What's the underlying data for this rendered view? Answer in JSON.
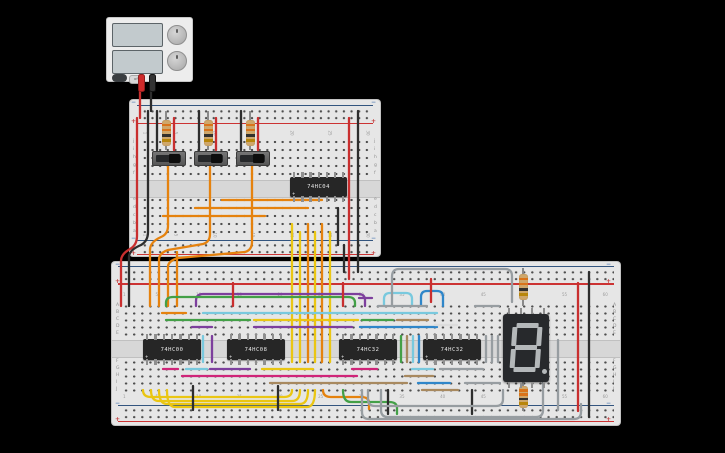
{
  "app": {
    "background": "#000000"
  },
  "power_supply": {
    "toggle_label": "off",
    "screens": 2,
    "knobs": 2,
    "probe_colors": [
      "#cf2b2b",
      "#333333"
    ]
  },
  "boards": {
    "upper": {
      "rows_top": [
        "j",
        "i",
        "h",
        "g",
        "f"
      ],
      "rows_bottom": [
        "e",
        "d",
        "c",
        "b",
        "a"
      ],
      "cols": [
        1,
        5,
        10,
        15,
        20,
        25,
        30
      ],
      "minus": "−",
      "plus": "+"
    },
    "lower": {
      "rows_top": [
        "A",
        "B",
        "C",
        "D",
        "E"
      ],
      "rows_bottom": [
        "F",
        "G",
        "H",
        "I",
        "J"
      ],
      "cols": [
        1,
        5,
        10,
        15,
        20,
        25,
        30,
        35,
        40,
        45,
        50,
        55,
        60
      ],
      "minus": "−",
      "plus": "+"
    }
  },
  "components": {
    "ic_mark": "+",
    "ics": [
      {
        "label": "74HC04",
        "x": 290,
        "y": 177,
        "w": 57,
        "h": 20,
        "pins": 7
      },
      {
        "label": "74HC00",
        "x": 143,
        "y": 339,
        "w": 58,
        "h": 21,
        "pins": 7
      },
      {
        "label": "74HC08",
        "x": 227,
        "y": 339,
        "w": 58,
        "h": 21,
        "pins": 7
      },
      {
        "label": "74HC32",
        "x": 339,
        "y": 339,
        "w": 58,
        "h": 21,
        "pins": 7
      },
      {
        "label": "74HC32",
        "x": 423,
        "y": 339,
        "w": 58,
        "h": 21,
        "pins": 7
      }
    ],
    "switches": [
      {
        "x": 152,
        "y": 151
      },
      {
        "x": 194,
        "y": 151
      },
      {
        "x": 236,
        "y": 151
      }
    ],
    "resistors": [
      {
        "x": 166,
        "lead": [
          111,
          150
        ],
        "body": [
          120,
          146
        ]
      },
      {
        "x": 208,
        "lead": [
          111,
          150
        ],
        "body": [
          120,
          146
        ]
      },
      {
        "x": 250,
        "lead": [
          111,
          150
        ],
        "body": [
          120,
          146
        ]
      },
      {
        "x": 523,
        "lead": [
          268,
          306
        ],
        "body": [
          274,
          300
        ]
      },
      {
        "x": 523,
        "lead": [
          382,
          411
        ],
        "body": [
          386,
          408
        ]
      }
    ],
    "resistor_bands": [
      "#d9731a",
      "#d9731a",
      "#33302c",
      "#b8860b"
    ],
    "display": {
      "x": 503,
      "y": 314,
      "w": 46,
      "h": 68,
      "value": "8."
    }
  },
  "colors": {
    "red": "#c92f2f",
    "black": "#2d2d2d",
    "orange": "#e5820e",
    "yellow": "#eac613",
    "green": "#43a047",
    "cyan": "#79c9de",
    "blue": "#2f86c9",
    "purple": "#7d3f9d",
    "pink": "#cf2579",
    "brown": "#a8895f",
    "dgray": "#979da1",
    "lightgray": "#dcdcdc"
  },
  "wires": [
    {
      "c": "red",
      "d": "M140,88 V118"
    },
    {
      "c": "black",
      "d": "M151,88 V111"
    },
    {
      "c": "red",
      "d": "M137,118 V236 Q137,245 130,249 Q121,254 121,261 V306"
    },
    {
      "c": "black",
      "d": "M148,111 V232 Q148,241 141,245 Q129,250 129,257 V306"
    },
    {
      "c": "red",
      "d": "M349,118 V279"
    },
    {
      "c": "black",
      "d": "M358,111 V272"
    },
    {
      "c": "black",
      "d": "M338,208 V245"
    },
    {
      "c": "black",
      "d": "M344,245 V272"
    },
    {
      "c": "black",
      "d": "M157,111 V150"
    },
    {
      "c": "black",
      "d": "M199,111 V150"
    },
    {
      "c": "black",
      "d": "M241,111 V150"
    },
    {
      "c": "red",
      "d": "M174,118 V150"
    },
    {
      "c": "red",
      "d": "M216,118 V150"
    },
    {
      "c": "red",
      "d": "M258,118 V150"
    },
    {
      "c": "orange",
      "d": "M168,164 V226 Q168,234 161,237 Q150,242 150,250 V306"
    },
    {
      "c": "orange",
      "d": "M210,164 V234 Q210,242 203,244 L168,250 Q159,253 159,260 V306"
    },
    {
      "c": "orange",
      "d": "M252,164 V242 Q252,250 245,252 L178,258 Q168,261 168,267 V306"
    },
    {
      "c": "orange",
      "d": "M177,252 V306"
    },
    {
      "c": "orange",
      "d": "M163,216 H265"
    },
    {
      "c": "orange",
      "d": "M195,208 H308"
    },
    {
      "c": "orange",
      "d": "M222,200 H322"
    },
    {
      "c": "yellow",
      "d": "M292,224 V362"
    },
    {
      "c": "yellow",
      "d": "M300,232 V362"
    },
    {
      "c": "orange",
      "d": "M308,224 V362"
    },
    {
      "c": "yellow",
      "d": "M315,232 V362"
    },
    {
      "c": "orange",
      "d": "M322,224 V362"
    },
    {
      "c": "yellow",
      "d": "M330,232 V362"
    },
    {
      "c": "purple",
      "d": "M196,306 V301 Q196,294 203,294 H358 Q365,294 365,300 V306"
    },
    {
      "c": "green",
      "d": "M166,306 V303 Q166,297 173,297 H348 Q355,297 355,303 V306"
    },
    {
      "c": "purple",
      "d": "M359,298 H372"
    },
    {
      "c": "cyan",
      "d": "M384,306 V299 Q384,293 390,293 H406 Q412,293 412,299 V306"
    },
    {
      "c": "blue",
      "d": "M421,306 V297 Q421,291 427,291 H437 Q443,291 443,297 V306"
    },
    {
      "c": "dgray",
      "d": "M392,306 V277 Q392,269 399,269 H505 Q512,269 512,276 V302"
    },
    {
      "c": "red",
      "d": "M233,283 V306"
    },
    {
      "c": "red",
      "d": "M343,283 V306"
    },
    {
      "c": "red",
      "d": "M431,279 V302"
    },
    {
      "c": "orange",
      "d": "M162,313 H186"
    },
    {
      "c": "cyan",
      "d": "M203,313 H437"
    },
    {
      "c": "green",
      "d": "M166,320 H250"
    },
    {
      "c": "yellow",
      "d": "M254,320 H358"
    },
    {
      "c": "green",
      "d": "M362,320 H393"
    },
    {
      "c": "brown",
      "d": "M397,320 H428"
    },
    {
      "c": "purple",
      "d": "M254,327 H352"
    },
    {
      "c": "purple",
      "d": "M192,327 H212"
    },
    {
      "c": "blue",
      "d": "M360,327 H437"
    },
    {
      "c": "dgray",
      "d": "M378,306 H427"
    },
    {
      "c": "dgray",
      "d": "M475,306 H499"
    },
    {
      "c": "lightgray",
      "d": "M435,325 H457"
    },
    {
      "c": "pink",
      "d": "M163,369 H178"
    },
    {
      "c": "cyan",
      "d": "M186,369 H207"
    },
    {
      "c": "purple",
      "d": "M210,369 H250"
    },
    {
      "c": "yellow",
      "d": "M262,369 H313"
    },
    {
      "c": "pink",
      "d": "M352,369 H377"
    },
    {
      "c": "cyan",
      "d": "M412,369 H433"
    },
    {
      "c": "dgray",
      "d": "M440,369 H483"
    },
    {
      "c": "pink",
      "d": "M182,376 H357"
    },
    {
      "c": "brown",
      "d": "M405,376 H433"
    },
    {
      "c": "brown",
      "d": "M270,383 H407"
    },
    {
      "c": "blue",
      "d": "M418,383 H450"
    },
    {
      "c": "dgray",
      "d": "M465,383 H500"
    },
    {
      "c": "brown",
      "d": "M422,390 H458"
    },
    {
      "c": "cyan",
      "d": "M203,336 V362"
    },
    {
      "c": "purple",
      "d": "M212,336 V362"
    },
    {
      "c": "green",
      "d": "M401,336 V362"
    },
    {
      "c": "brown",
      "d": "M407,336 V362"
    },
    {
      "c": "cyan",
      "d": "M413,336 V362"
    },
    {
      "c": "blue",
      "d": "M419,336 V362"
    },
    {
      "c": "dgray",
      "d": "M486,336 V362"
    },
    {
      "c": "dgray",
      "d": "M492,336 V362"
    },
    {
      "c": "dgray",
      "d": "M498,336 V362"
    },
    {
      "c": "yellow",
      "d": "M143,390 Q143,397 151,397 H284 Q292,397 292,390"
    },
    {
      "c": "yellow",
      "d": "M151,390 Q151,401 159,401 H292 Q300,401 300,390"
    },
    {
      "c": "yellow",
      "d": "M159,390 Q159,404 167,404 H300 Q308,404 308,390"
    },
    {
      "c": "yellow",
      "d": "M167,390 Q167,407 175,407 H307 Q315,407 315,390"
    },
    {
      "c": "orange",
      "d": "M323,390 Q323,397 331,397 H361 Q369,397 369,403 V409"
    },
    {
      "c": "green",
      "d": "M343,390 Q343,402 351,402 H389 Q397,402 397,408 V414"
    },
    {
      "c": "black",
      "d": "M193,386 V410"
    },
    {
      "c": "black",
      "d": "M278,386 V410"
    },
    {
      "c": "black",
      "d": "M388,390 V414"
    },
    {
      "c": "black",
      "d": "M472,390 V414"
    },
    {
      "c": "dgray",
      "d": "M368,390 V399 Q368,406 375,406 H496 Q503,406 503,399 V390"
    },
    {
      "c": "dgray",
      "d": "M381,390 V410 Q381,417 388,417 H536 Q543,417 543,410 V372"
    },
    {
      "c": "dgray",
      "d": "M362,390 V412 Q362,419 369,419 H574 Q581,419 581,412 V404"
    },
    {
      "c": "dgray",
      "d": "M558,340 V410"
    },
    {
      "c": "red",
      "d": "M578,283 V411"
    },
    {
      "c": "black",
      "d": "M589,272 V417"
    }
  ]
}
